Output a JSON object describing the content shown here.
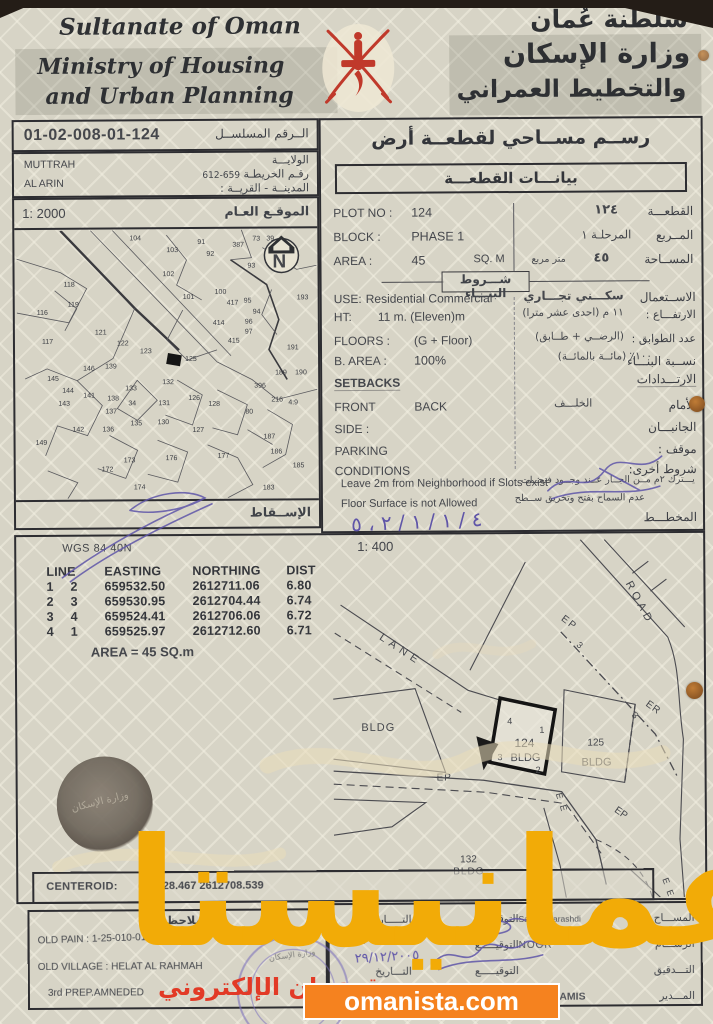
{
  "header": {
    "country_en": "Sultanate of Oman",
    "ministry_en_1": "Ministry of Housing",
    "ministry_en_2": "and Urban Planning",
    "country_ar": "سلطنة عُمان",
    "ministry_ar_1": "وزارة الإسكان",
    "ministry_ar_2": "والتخطيط العمراني",
    "emblem_color": "#c0392b"
  },
  "serial": {
    "value": "01-02-008-01-124",
    "label_ar": "الــرقم المسلســل"
  },
  "location": {
    "wilaya_en": "MUTTRAH",
    "village_en": "AL ARIN",
    "wilaya_label_ar": "الولايـــة",
    "map_label_ar": "رقـم الخريطـة",
    "map_no": "659-612",
    "town_label_ar": "المدينــة - القريــة :"
  },
  "site_map": {
    "scale": "1: 2000",
    "title_ar": "الموقـع العـام",
    "projection_ar": "الإســقاط",
    "north_letter": "N",
    "highlight_plot": "124",
    "numbers": [
      {
        "n": "104",
        "x": 113,
        "y": 10
      },
      {
        "n": "91",
        "x": 181,
        "y": 14
      },
      {
        "n": "92",
        "x": 190,
        "y": 26
      },
      {
        "n": "103",
        "x": 150,
        "y": 22
      },
      {
        "n": "387",
        "x": 216,
        "y": 17
      },
      {
        "n": "73",
        "x": 236,
        "y": 11
      },
      {
        "n": "39",
        "x": 250,
        "y": 11
      },
      {
        "n": "102",
        "x": 146,
        "y": 46
      },
      {
        "n": "93",
        "x": 231,
        "y": 38
      },
      {
        "n": "118",
        "x": 47,
        "y": 56
      },
      {
        "n": "101",
        "x": 166,
        "y": 69
      },
      {
        "n": "100",
        "x": 198,
        "y": 64
      },
      {
        "n": "417",
        "x": 210,
        "y": 75
      },
      {
        "n": "95",
        "x": 227,
        "y": 73
      },
      {
        "n": "94",
        "x": 236,
        "y": 84
      },
      {
        "n": "119",
        "x": 51,
        "y": 76
      },
      {
        "n": "116",
        "x": 20,
        "y": 84
      },
      {
        "n": "193",
        "x": 280,
        "y": 70
      },
      {
        "n": "414",
        "x": 196,
        "y": 95
      },
      {
        "n": "96",
        "x": 228,
        "y": 94
      },
      {
        "n": "97",
        "x": 228,
        "y": 104
      },
      {
        "n": "121",
        "x": 78,
        "y": 104
      },
      {
        "n": "117",
        "x": 25,
        "y": 113
      },
      {
        "n": "415",
        "x": 211,
        "y": 113
      },
      {
        "n": "122",
        "x": 100,
        "y": 115
      },
      {
        "n": "123",
        "x": 123,
        "y": 123
      },
      {
        "n": "191",
        "x": 270,
        "y": 120
      },
      {
        "n": "146",
        "x": 66,
        "y": 140
      },
      {
        "n": "139",
        "x": 88,
        "y": 138
      },
      {
        "n": "125",
        "x": 168,
        "y": 131
      },
      {
        "n": "132",
        "x": 145,
        "y": 154
      },
      {
        "n": "145",
        "x": 30,
        "y": 150
      },
      {
        "n": "133",
        "x": 108,
        "y": 160
      },
      {
        "n": "189",
        "x": 258,
        "y": 145
      },
      {
        "n": "190",
        "x": 278,
        "y": 145
      },
      {
        "n": "396",
        "x": 237,
        "y": 158
      },
      {
        "n": "144",
        "x": 45,
        "y": 162
      },
      {
        "n": "141",
        "x": 66,
        "y": 167
      },
      {
        "n": "138",
        "x": 90,
        "y": 170
      },
      {
        "n": "34",
        "x": 111,
        "y": 175
      },
      {
        "n": "131",
        "x": 141,
        "y": 175
      },
      {
        "n": "126",
        "x": 171,
        "y": 170
      },
      {
        "n": "128",
        "x": 191,
        "y": 176
      },
      {
        "n": "216",
        "x": 254,
        "y": 172
      },
      {
        "n": "4:9",
        "x": 271,
        "y": 175
      },
      {
        "n": "143",
        "x": 41,
        "y": 175
      },
      {
        "n": "137",
        "x": 88,
        "y": 183
      },
      {
        "n": "135",
        "x": 113,
        "y": 195
      },
      {
        "n": "130",
        "x": 140,
        "y": 194
      },
      {
        "n": "142",
        "x": 55,
        "y": 201
      },
      {
        "n": "136",
        "x": 85,
        "y": 201
      },
      {
        "n": "149",
        "x": 18,
        "y": 214
      },
      {
        "n": "127",
        "x": 175,
        "y": 202
      },
      {
        "n": "80",
        "x": 228,
        "y": 184
      },
      {
        "n": "187",
        "x": 246,
        "y": 209
      },
      {
        "n": "186",
        "x": 253,
        "y": 224
      },
      {
        "n": "177",
        "x": 200,
        "y": 228
      },
      {
        "n": "173",
        "x": 106,
        "y": 232
      },
      {
        "n": "176",
        "x": 148,
        "y": 230
      },
      {
        "n": "185",
        "x": 275,
        "y": 238
      },
      {
        "n": "172",
        "x": 84,
        "y": 241
      },
      {
        "n": "174",
        "x": 116,
        "y": 259
      },
      {
        "n": "183",
        "x": 245,
        "y": 260
      }
    ]
  },
  "survey": {
    "title_ar": "رســم مســاحي لقطعــة أرض",
    "subtitle_ar": "بيانـــات القطعـــة"
  },
  "plot_info": {
    "plot_no": {
      "en_label": "PLOT NO :",
      "en_value": "124",
      "ar_value": "١٢٤",
      "ar_label": "القطعـــة"
    },
    "block": {
      "en_label": "BLOCK :",
      "en_value": "PHASE 1",
      "ar_value": "المرحلـة ١",
      "ar_label": "المــربع"
    },
    "area": {
      "en_label": "AREA :",
      "en_value": "45",
      "en_unit": "SQ. M",
      "ar_value": "٤٥",
      "ar_unit": "متر مربع",
      "ar_label": "المســاحة"
    }
  },
  "building": {
    "title_ar": "شـــروط البنـــاء",
    "use": {
      "en_label": "USE:",
      "en_value": "Residential Commercial",
      "ar_value": "سكـــني تجـــاري",
      "ar_label": "الاســتعمال"
    },
    "height": {
      "en_label": "HT:",
      "en_value": "11 m. (Eleven)m",
      "ar_value": "١١ م  (احدى عشر مترا)",
      "ar_label": "الارتفـــاع :"
    },
    "floors": {
      "en_label": "FLOORS :",
      "en_value": "(G + Floor)",
      "ar_value": "(الرضــي + طــابق)",
      "ar_label": "عدد الطوابق :"
    },
    "b_area": {
      "en_label": "B. AREA :",
      "en_value": "100%",
      "ar_value": "١٠٠٪ (مائــة بالمائــة)",
      "ar_label": "نســبة البنـــاء"
    },
    "setbacks": {
      "en_label": "SETBACKS",
      "ar_label": "الارتـــدادات"
    },
    "front": {
      "en_label": "FRONT",
      "en_value": "BACK",
      "ar_value": "الخلـــف",
      "ar_label": "الأمام"
    },
    "side": {
      "en_label": "SIDE :",
      "ar_label": "الجانبـــان"
    },
    "parking": {
      "en_label": "PARKING",
      "ar_label": "موقف :"
    },
    "conditions": {
      "en_label": "CONDITIONS",
      "ar_label": "شروط أخرى:"
    },
    "condition_1": {
      "en": "Leave 2m from Neighborhood if Slots exist",
      "ar": "يـــترك ٢م مــن الجــار عــند وجــود فتحــات"
    },
    "condition_2": {
      "en": "Floor Surface is not Allowed",
      "ar": "عدم السماح بفتح وتخريق ســطح"
    },
    "plan_label_ar": "المخطـــط"
  },
  "coordinates": {
    "datum": "WGS 84  40N",
    "headers": [
      "LINE",
      "EASTING",
      "NORTHING",
      "DIST"
    ],
    "rows": [
      [
        "1",
        "2",
        "659532.50",
        "2612711.06",
        "6.80"
      ],
      [
        "2",
        "3",
        "659530.95",
        "2612704.44",
        "6.74"
      ],
      [
        "3",
        "4",
        "659524.41",
        "2612706.06",
        "6.72"
      ],
      [
        "4",
        "1",
        "659525.97",
        "2612712.60",
        "6.71"
      ]
    ],
    "area_note": "AREA = 45  SQ.m"
  },
  "detail_map": {
    "scale": "1: 400",
    "annotations": [
      {
        "t": "LANE",
        "x": 46,
        "y": 98,
        "r": 34,
        "s": 11,
        "ls": 5
      },
      {
        "t": "ROAD",
        "x": 293,
        "y": 44,
        "r": 62,
        "s": 11,
        "ls": 4
      },
      {
        "t": "EP",
        "x": 228,
        "y": 80,
        "r": 38,
        "s": 10,
        "ls": 2
      },
      {
        "t": "3",
        "x": 243,
        "y": 106,
        "r": 42,
        "s": 9
      },
      {
        "t": "3",
        "x": 298,
        "y": 176,
        "r": 50,
        "s": 9
      },
      {
        "t": "ER",
        "x": 312,
        "y": 166,
        "r": 36,
        "s": 10,
        "ls": 1
      },
      {
        "t": "BLDG",
        "x": 28,
        "y": 190,
        "s": 11,
        "ls": 1
      },
      {
        "t": "4",
        "x": 174,
        "y": 184,
        "s": 9
      },
      {
        "t": "1",
        "x": 206,
        "y": 193,
        "s": 9
      },
      {
        "t": "3",
        "x": 164,
        "y": 220,
        "s": 9
      },
      {
        "t": "2",
        "x": 202,
        "y": 233,
        "s": 9
      },
      {
        "t": "124",
        "x": 181,
        "y": 207,
        "s": 12
      },
      {
        "t": "BLDG",
        "x": 177,
        "y": 221,
        "s": 11
      },
      {
        "t": "125",
        "x": 254,
        "y": 206,
        "s": 10
      },
      {
        "t": "BLDG",
        "x": 248,
        "y": 226,
        "s": 11
      },
      {
        "t": "EP",
        "x": 103,
        "y": 240,
        "s": 10,
        "ls": 1
      },
      {
        "t": "E",
        "x": 222,
        "y": 254,
        "r": 75,
        "s": 9
      },
      {
        "t": "E",
        "x": 226,
        "y": 266,
        "r": 75,
        "s": 9
      },
      {
        "t": "EP",
        "x": 280,
        "y": 272,
        "r": 35,
        "s": 10
      },
      {
        "t": "E",
        "x": 328,
        "y": 340,
        "r": 70,
        "s": 9
      },
      {
        "t": "E",
        "x": 332,
        "y": 352,
        "r": 70,
        "s": 9
      },
      {
        "t": "132",
        "x": 126,
        "y": 322,
        "s": 10
      },
      {
        "t": "BLDG",
        "x": 119,
        "y": 334,
        "s": 10,
        "ls": 1
      }
    ]
  },
  "centeroid": {
    "label": "CENTEROID:",
    "value": "659528.467 2612708.539"
  },
  "notes": {
    "title_ar": "الملاحظــات",
    "old_pain": "OLD PAIN : 1-25-010-01-0",
    "old_village": "OLD VILLAGE : HELAT AL RAHMAH",
    "prep": "3rd PREP.AMNEDED"
  },
  "signatures": {
    "sig_label_ar": "التوقيـــــع",
    "rows": [
      {
        "role_ar": "المســـاح",
        "name": "Saim AlBarashdi",
        "date_label_ar": "التـــــاريـخ"
      },
      {
        "role_ar": "الرســـام",
        "name": "NOOR",
        "date_label_ar": ""
      },
      {
        "role_ar": "التـــدقيق",
        "name": "",
        "date_label_ar": "التـــاريخ"
      },
      {
        "role_ar": "المـــدير",
        "name": "MUBARAK KHAMIS",
        "date_label_ar": ""
      }
    ]
  },
  "handwriting": {
    "cond_date": "٤ / ١ / ١ / ٢ ، ٥",
    "drafts_date": "02/",
    "audit_date": "٢٩/١٢/٢٠٠٥",
    "director_mark": "/ ١"
  },
  "watermark": {
    "big_text": "عمانيستا",
    "big_color": "#f2ab07",
    "red_text": "سوق عمان الإلكتروني",
    "red_color": "#e23a26",
    "banner_text": "omanista.com",
    "banner_color": "#f5821f"
  },
  "stamps": {
    "seal_text_ar": "وزارة الإسكان",
    "round_text_ar": "وزارة الإسكان"
  }
}
